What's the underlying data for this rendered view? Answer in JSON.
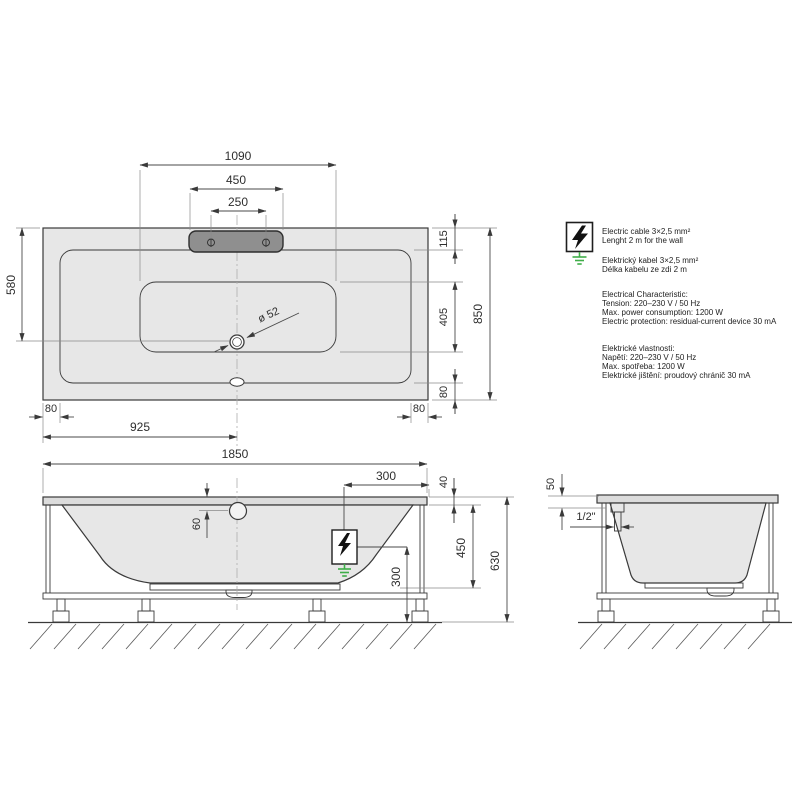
{
  "drawing": {
    "dims": {
      "top": {
        "inner_basin_length": "1090",
        "headrest_width": "450",
        "headrest_hole_spacing": "250",
        "basin_depth_left": "580",
        "overall_width": "850",
        "rim_head_width": "115",
        "basin_floor_width": "405",
        "rim_foot_width": "80",
        "rim_left": "80",
        "rim_right": "80",
        "edge_to_center": "925",
        "drain_diameter": "ø 52"
      },
      "side": {
        "overall_length": "1850",
        "cable_from_end": "300",
        "rim_thickness": "40",
        "overflow_below_rim": "60",
        "shell_depth": "450",
        "overall_height": "630",
        "cable_above_floor": "300"
      },
      "end": {
        "rim_offset": "50",
        "connection_size": "1/2\""
      }
    }
  },
  "notes": {
    "cable_en": [
      "Electric cable 3×2,5 mm²",
      "Lenght 2 m for the wall"
    ],
    "cable_cz": [
      "Elektrický kabel 3×2,5 mm²",
      "Délka kabelu ze zdi 2 m"
    ],
    "electrical_en": [
      "Electrical Characteristic:",
      "Tension: 220–230 V / 50 Hz",
      "Max. power consumption: 1200 W",
      "Electric protection: residual-current device 30 mA"
    ],
    "electrical_cz": [
      "Elektrické vlastnosti:",
      "Napětí: 220–230 V / 50 Hz",
      "Max. spotřeba: 1200 W",
      "Elektrické jištění: proudový chránič 30 mA"
    ]
  },
  "icons": {
    "electric": "lightning-bolt-in-box",
    "earth": "ground-symbol"
  },
  "colors": {
    "background": "#ffffff",
    "tub_fill": "#e7e7e7",
    "rim_fill": "#dcdcdc",
    "headrest_fill": "#8f8f8f",
    "outline": "#333333",
    "dimension_line": "#4a4a4a",
    "extension_line": "#8a8a8a",
    "earth_green": "#3fae49"
  }
}
